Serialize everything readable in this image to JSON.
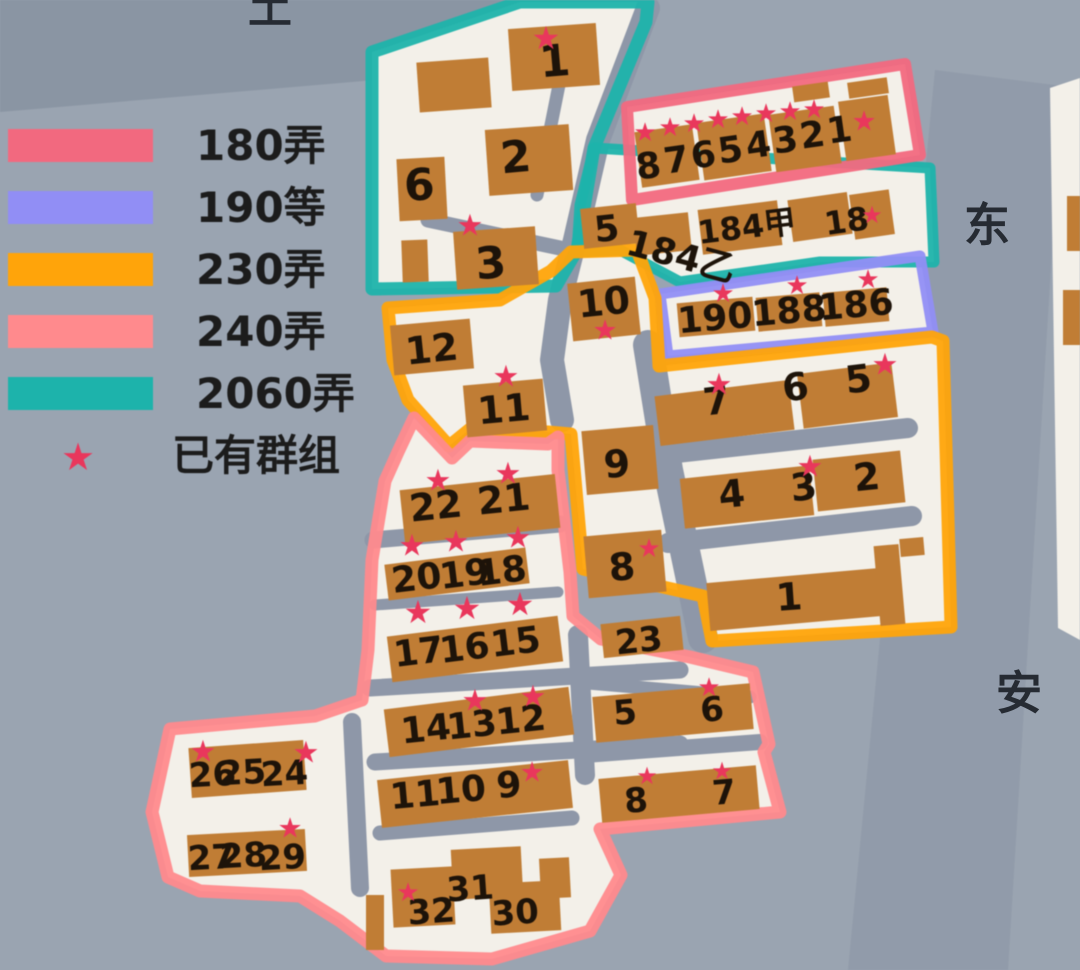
{
  "legend": {
    "items": [
      {
        "label": "180弄",
        "color": "#f2697f"
      },
      {
        "label": "190等",
        "color": "#918ef5"
      },
      {
        "label": "230弄",
        "color": "#ffa40a"
      },
      {
        "label": "240弄",
        "color": "#ff8a8d"
      },
      {
        "label": "2060弄",
        "color": "#1db3ab"
      }
    ],
    "star_item": {
      "label": "已有群组",
      "color": "#e9375c"
    }
  },
  "street_labels": [
    {
      "text": "土"
    },
    {
      "text": "东"
    },
    {
      "text": "安"
    }
  ],
  "palette": {
    "bg": "#9aa4b1",
    "bg_dark": "#7e8898",
    "street": "#8b94a4",
    "paper": "#f3f0e9",
    "road": "#8e97a8",
    "building": "#c07d35",
    "number": "#1d1309",
    "star": "#e9375c",
    "legend_text": "#1c1c1c"
  },
  "map": {
    "regions": [
      {
        "name": "2060弄-main",
        "color": "#1db3ab",
        "width": 13,
        "points": "372,52 520,2 648,2 646,22 594,148 577,250 556,286 372,289"
      },
      {
        "name": "2060弄-strip",
        "color": "#1db3ab",
        "width": 11,
        "points": "594,148 930,168 934,262 820,262 680,282 620,250 577,252 580,205"
      },
      {
        "name": "180弄",
        "color": "#f2697f",
        "width": 12,
        "points": "627,107 905,64 920,155 632,200"
      },
      {
        "name": "190等",
        "color": "#918ef5",
        "width": 11,
        "points": "660,294 920,256 933,332 668,356"
      },
      {
        "name": "230弄",
        "color": "#ffa40a",
        "width": 13,
        "points": "388,308 500,300 551,271 571,252 637,250 655,298 659,366 932,337 943,341 951,627 712,641 703,596 583,569 571,434 548,432 470,429 449,446 408,400 393,360"
      },
      {
        "name": "240弄",
        "color": "#ff8a8d",
        "width": 13,
        "points": "558,437 548,444 470,441 452,458 414,418 398,452 385,481 372,560 368,650 362,700 315,716 170,729 152,812 168,877 200,891 300,896 340,921 386,956 492,959 590,931 621,875 600,829 780,812 764,752 769,744 753,672 690,657 601,639 573,616 570,572 558,470"
      }
    ],
    "white_areas": [
      {
        "points": "1050,88 1080,78 1080,640 1058,628"
      }
    ],
    "bg_bands": {
      "dark_top": "0,0 555,0 375,80 0,112",
      "street_right": "935,70 1062,86 1008,970 848,970"
    },
    "roads": [
      {
        "pts": "648,8 598,140 575,240 560,300 552,360 562,420",
        "w": 24
      },
      {
        "pts": "562,70 537,195",
        "w": 13
      },
      {
        "pts": "428,220 560,248",
        "w": 15
      },
      {
        "pts": "648,345 668,470 690,575 703,638",
        "w": 30
      },
      {
        "pts": "658,455 908,428",
        "w": 20
      },
      {
        "pts": "668,543 912,516",
        "w": 20
      },
      {
        "pts": "373,540 560,524",
        "w": 17
      },
      {
        "pts": "375,605 558,592",
        "w": 11
      },
      {
        "pts": "370,688 680,670",
        "w": 17
      },
      {
        "pts": "375,762 680,744",
        "w": 17
      },
      {
        "pts": "380,833 572,818",
        "w": 15
      },
      {
        "pts": "578,635 585,775",
        "w": 20
      },
      {
        "pts": "588,683 750,697",
        "w": 13
      },
      {
        "pts": "585,755 760,742",
        "w": 16
      },
      {
        "pts": "352,722 360,888",
        "w": 18
      }
    ],
    "buildings": [
      [
        418,
        60,
        72,
        50,
        -4
      ],
      [
        510,
        26,
        88,
        62,
        -4
      ],
      [
        487,
        127,
        84,
        66,
        -4
      ],
      [
        398,
        158,
        48,
        62,
        -3
      ],
      [
        455,
        229,
        82,
        58,
        -4
      ],
      [
        402,
        240,
        26,
        42,
        -2
      ],
      [
        582,
        206,
        56,
        40,
        -6
      ],
      [
        635,
        215,
        55,
        38,
        -6
      ],
      [
        700,
        205,
        80,
        45,
        -7
      ],
      [
        790,
        196,
        60,
        42,
        -8
      ],
      [
        852,
        192,
        40,
        45,
        -8
      ],
      [
        638,
        128,
        58,
        56,
        -8
      ],
      [
        700,
        118,
        68,
        58,
        -8
      ],
      [
        772,
        110,
        66,
        58,
        -8
      ],
      [
        842,
        98,
        50,
        60,
        -8
      ],
      [
        793,
        84,
        36,
        16,
        -8
      ],
      [
        848,
        80,
        40,
        16,
        -8
      ],
      [
        678,
        300,
        76,
        34,
        -5
      ],
      [
        757,
        295,
        64,
        34,
        -5
      ],
      [
        824,
        290,
        64,
        34,
        -5
      ],
      [
        657,
        388,
        135,
        50,
        -7
      ],
      [
        800,
        368,
        95,
        55,
        -7
      ],
      [
        682,
        472,
        130,
        50,
        -6
      ],
      [
        815,
        455,
        88,
        52,
        -6
      ],
      [
        708,
        575,
        185,
        48,
        -5
      ],
      [
        877,
        545,
        25,
        80,
        -5
      ],
      [
        900,
        538,
        24,
        18,
        -5
      ],
      [
        570,
        280,
        68,
        58,
        -6
      ],
      [
        584,
        428,
        72,
        64,
        -5
      ],
      [
        586,
        533,
        78,
        62,
        -5
      ],
      [
        602,
        620,
        80,
        34,
        -6
      ],
      [
        392,
        322,
        80,
        50,
        -5
      ],
      [
        465,
        382,
        80,
        52,
        -5
      ],
      [
        402,
        482,
        156,
        54,
        -6
      ],
      [
        386,
        556,
        142,
        36,
        -7
      ],
      [
        389,
        626,
        172,
        46,
        -7
      ],
      [
        386,
        698,
        186,
        48,
        -7
      ],
      [
        379,
        770,
        192,
        48,
        -6
      ],
      [
        190,
        744,
        115,
        50,
        -4
      ],
      [
        188,
        832,
        118,
        42,
        -3
      ],
      [
        392,
        868,
        62,
        58,
        -3
      ],
      [
        452,
        848,
        70,
        50,
        -3
      ],
      [
        490,
        882,
        70,
        50,
        -3
      ],
      [
        540,
        858,
        30,
        40,
        -3
      ],
      [
        366,
        895,
        18,
        55,
        0
      ],
      [
        594,
        690,
        158,
        46,
        -5
      ],
      [
        600,
        772,
        158,
        44,
        -5
      ],
      [
        1067,
        196,
        13,
        55,
        0
      ],
      [
        1063,
        290,
        17,
        55,
        0
      ]
    ],
    "numbers": [
      [
        "1",
        556,
        76,
        44,
        -5
      ],
      [
        "2",
        517,
        172,
        44,
        -5
      ],
      [
        "6",
        420,
        200,
        44,
        -3
      ],
      [
        "3",
        492,
        278,
        44,
        -5
      ],
      [
        "5",
        608,
        241,
        36,
        -6
      ],
      [
        "10",
        605,
        315,
        38,
        -6
      ],
      [
        "8",
        650,
        178,
        36,
        -8
      ],
      [
        "7",
        678,
        172,
        36,
        -8
      ],
      [
        "6",
        705,
        167,
        36,
        -8
      ],
      [
        "5",
        732,
        162,
        36,
        -8
      ],
      [
        "4",
        760,
        157,
        36,
        -8
      ],
      [
        "3",
        787,
        152,
        36,
        -8
      ],
      [
        "2",
        814,
        147,
        36,
        -8
      ],
      [
        "1",
        841,
        142,
        36,
        -8
      ],
      [
        "190",
        716,
        330,
        36,
        -5
      ],
      [
        "188",
        790,
        323,
        36,
        -5
      ],
      [
        "186",
        857,
        317,
        36,
        -5
      ],
      [
        "7",
        718,
        414,
        38,
        -7
      ],
      [
        "6",
        797,
        400,
        38,
        -7
      ],
      [
        "5",
        860,
        392,
        38,
        -7
      ],
      [
        "4",
        733,
        507,
        38,
        -6
      ],
      [
        "3",
        805,
        500,
        38,
        -6
      ],
      [
        "2",
        868,
        490,
        38,
        -6
      ],
      [
        "1",
        790,
        610,
        38,
        -4
      ],
      [
        "9",
        618,
        477,
        38,
        -5
      ],
      [
        "8",
        623,
        580,
        38,
        -5
      ],
      [
        "23",
        640,
        652,
        34,
        -6
      ],
      [
        "12",
        433,
        362,
        38,
        -6
      ],
      [
        "11",
        505,
        422,
        38,
        -5
      ],
      [
        "22",
        437,
        519,
        38,
        -6
      ],
      [
        "21",
        505,
        512,
        38,
        -6
      ],
      [
        "20",
        418,
        590,
        36,
        -7
      ],
      [
        "19",
        466,
        586,
        36,
        -7
      ],
      [
        "18",
        503,
        583,
        36,
        -7
      ],
      [
        "17",
        420,
        664,
        36,
        -7
      ],
      [
        "16",
        466,
        660,
        36,
        -7
      ],
      [
        "15",
        517,
        654,
        36,
        -7
      ],
      [
        "14",
        427,
        741,
        36,
        -6
      ],
      [
        "13",
        473,
        737,
        36,
        -6
      ],
      [
        "12",
        522,
        732,
        36,
        -6
      ],
      [
        "11",
        416,
        807,
        36,
        -5
      ],
      [
        "10",
        462,
        802,
        36,
        -5
      ],
      [
        "9",
        510,
        797,
        36,
        -5
      ],
      [
        "26",
        213,
        786,
        34,
        -3
      ],
      [
        "25",
        243,
        784,
        34,
        -3
      ],
      [
        "24",
        285,
        785,
        34,
        -3
      ],
      [
        "27",
        212,
        869,
        34,
        -3
      ],
      [
        "28",
        244,
        867,
        34,
        -3
      ],
      [
        "29",
        283,
        869,
        34,
        -3
      ],
      [
        "31",
        471,
        900,
        34,
        -4
      ],
      [
        "32",
        432,
        923,
        34,
        -4
      ],
      [
        "30",
        516,
        924,
        34,
        -4
      ],
      [
        "5",
        626,
        724,
        34,
        -5
      ],
      [
        "6",
        713,
        721,
        34,
        -5
      ],
      [
        "8",
        637,
        812,
        34,
        -5
      ],
      [
        "7",
        725,
        804,
        34,
        -5
      ]
    ],
    "texts": [
      {
        "t": "184甲",
        "x": 748,
        "y": 238,
        "s": 32,
        "r": -7
      },
      {
        "t": "18",
        "x": 848,
        "y": 232,
        "s": 32,
        "r": -8
      },
      {
        "t": "184乙",
        "x": 678,
        "y": 268,
        "s": 36,
        "r": 15
      }
    ],
    "stars": [
      [
        546,
        38,
        32
      ],
      [
        470,
        226,
        30
      ],
      [
        605,
        330,
        28
      ],
      [
        506,
        377,
        30
      ],
      [
        645,
        133,
        26
      ],
      [
        670,
        128,
        26
      ],
      [
        694,
        124,
        26
      ],
      [
        718,
        120,
        26
      ],
      [
        742,
        117,
        26
      ],
      [
        766,
        114,
        26
      ],
      [
        790,
        112,
        26
      ],
      [
        814,
        110,
        26
      ],
      [
        864,
        121,
        28
      ],
      [
        872,
        215,
        24
      ],
      [
        723,
        294,
        26
      ],
      [
        797,
        286,
        26
      ],
      [
        868,
        280,
        26
      ],
      [
        719,
        385,
        30
      ],
      [
        885,
        365,
        30
      ],
      [
        810,
        467,
        30
      ],
      [
        649,
        549,
        26
      ],
      [
        438,
        481,
        30
      ],
      [
        508,
        474,
        30
      ],
      [
        412,
        546,
        30
      ],
      [
        456,
        542,
        30
      ],
      [
        518,
        538,
        30
      ],
      [
        418,
        612,
        32
      ],
      [
        467,
        608,
        32
      ],
      [
        520,
        604,
        32
      ],
      [
        475,
        701,
        30
      ],
      [
        533,
        697,
        30
      ],
      [
        532,
        772,
        28
      ],
      [
        203,
        752,
        30
      ],
      [
        306,
        753,
        30
      ],
      [
        290,
        828,
        28
      ],
      [
        408,
        893,
        26
      ],
      [
        709,
        688,
        26
      ],
      [
        647,
        776,
        24
      ],
      [
        722,
        771,
        24
      ]
    ]
  }
}
